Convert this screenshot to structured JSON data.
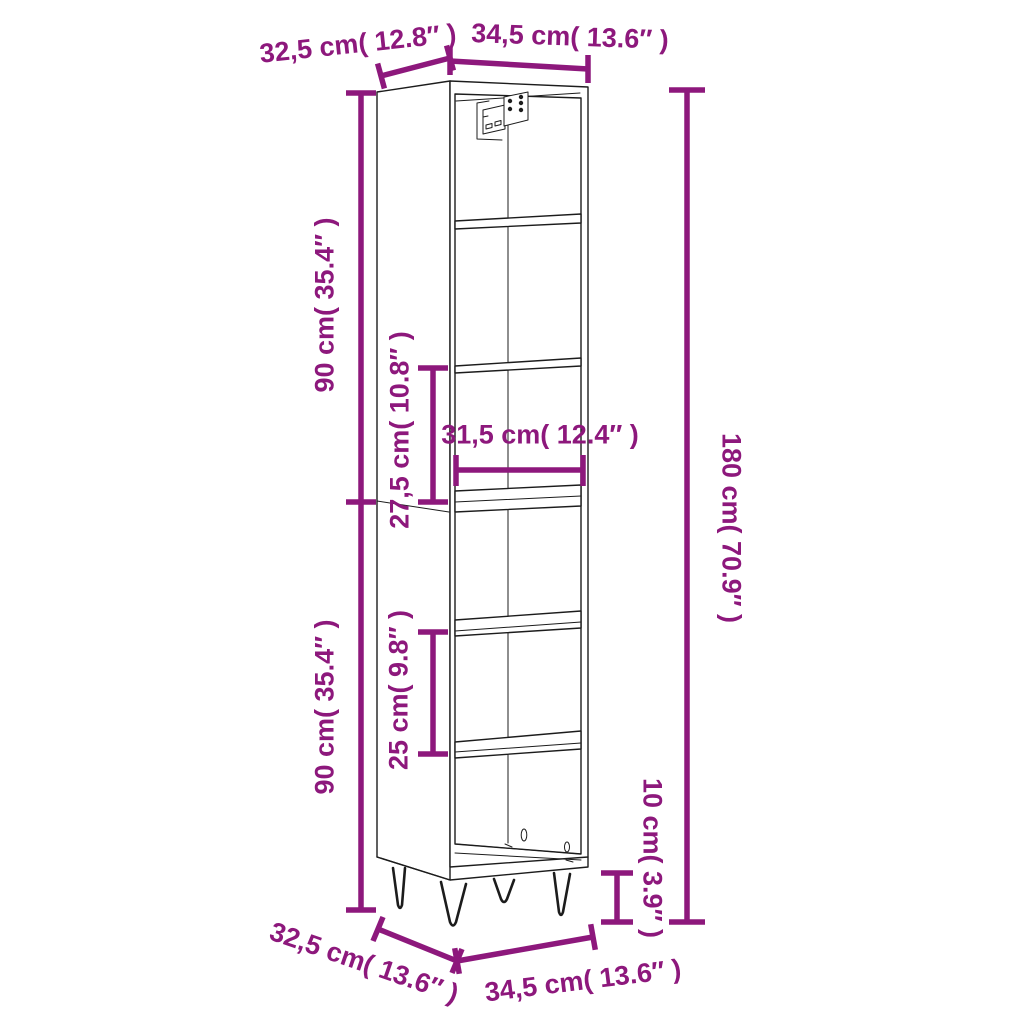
{
  "figure": {
    "subject": "tall-cabinet-dimension-diagram",
    "accent_color": "#8D187C",
    "line_color": "#1c1c1c",
    "background_color": "#ffffff",
    "dimensions": {
      "top_depth": "32,5 cm( 12.8″ )",
      "top_width": "34,5 cm( 13.6″ )",
      "upper_section_height": "90 cm( 35.4″ )",
      "upper_compartment_height": "27,5 cm( 10.8″ )",
      "shelf_inner_width": "31,5 cm( 12.4″ )",
      "lower_section_height": "90 cm( 35.4″ )",
      "lower_compartment_height": "25 cm( 9.8″ )",
      "total_height": "180 cm( 70.9″ )",
      "leg_height": "10 cm( 3.9″ )",
      "bottom_depth": "32,5 cm( 13.6″ )",
      "bottom_width": "34,5 cm( 13.6″ )"
    }
  }
}
